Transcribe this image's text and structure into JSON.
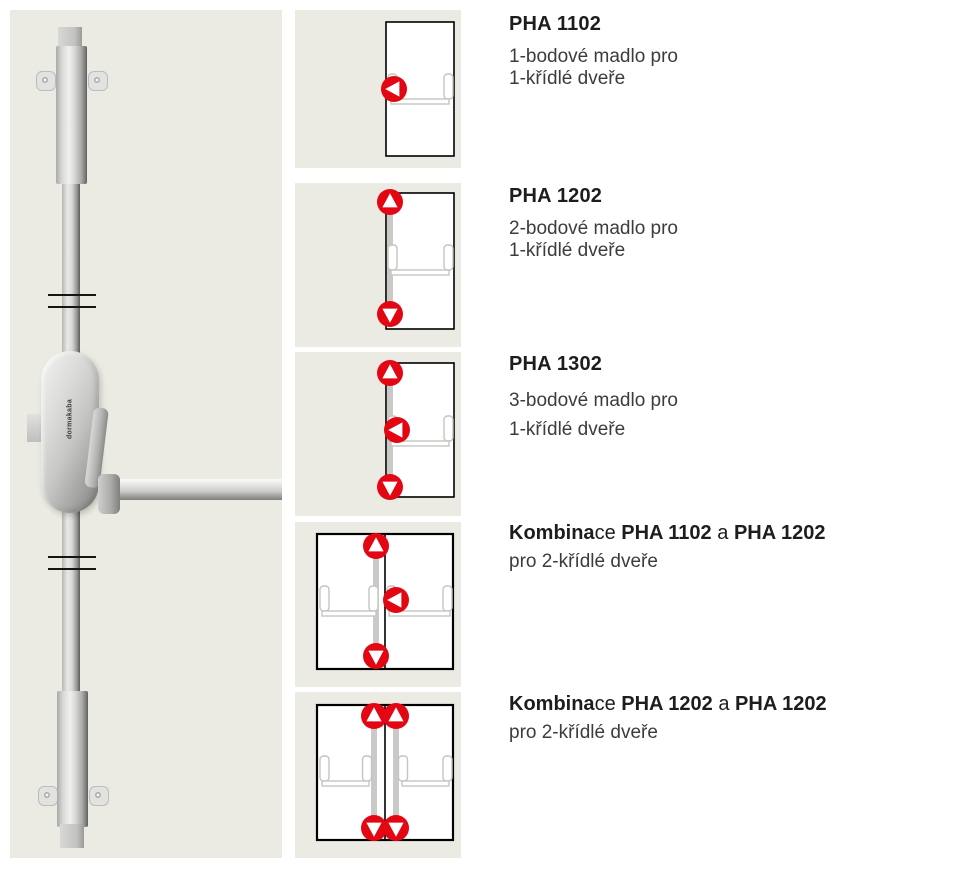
{
  "colors": {
    "accent_red": "#e30613",
    "panel_bg": "#ebebe3",
    "hardware_gray": "#c9c9c7",
    "door_outline": "#000000"
  },
  "device": {
    "logo_text": "dormakaba"
  },
  "products": [
    {
      "code": "PHA 1102",
      "description": [
        "1-bodové madlo pro",
        "1-křídlé dveře"
      ],
      "diagram": {
        "doors": 1,
        "points": [
          {
            "dir": "left",
            "x": 99,
            "y": 79
          }
        ]
      }
    },
    {
      "code": "PHA 1202",
      "description": [
        "2-bodové madlo pro",
        "1-křídlé dveře"
      ],
      "diagram": {
        "doors": 1,
        "points": [
          {
            "dir": "up",
            "x": 95,
            "y": 19
          },
          {
            "dir": "down",
            "x": 95,
            "y": 131
          }
        ]
      }
    },
    {
      "code": "PHA 1302",
      "description": [
        "3-bodové madlo pro",
        "1-křídlé dveře"
      ],
      "diagram": {
        "doors": 1,
        "points": [
          {
            "dir": "up",
            "x": 95,
            "y": 21
          },
          {
            "dir": "left",
            "x": 102,
            "y": 78
          },
          {
            "dir": "down",
            "x": 95,
            "y": 135
          }
        ]
      }
    },
    {
      "heading_parts": [
        "Kombina",
        "ce ",
        "PHA 1102",
        " a ",
        "PHA 1202"
      ],
      "description": [
        "pro 2-křídlé dveře"
      ],
      "diagram": {
        "doors": 2,
        "points": [
          {
            "dir": "up",
            "x": 81,
            "y": 24
          },
          {
            "dir": "left",
            "x": 101,
            "y": 78
          },
          {
            "dir": "down",
            "x": 81,
            "y": 134
          }
        ]
      }
    },
    {
      "heading_parts": [
        "Kombina",
        "ce ",
        "PHA 1202",
        " a ",
        "PHA 1202"
      ],
      "description": [
        "pro 2-křídlé dveře"
      ],
      "diagram": {
        "doors": 2,
        "points": [
          {
            "dir": "up",
            "x": 79,
            "y": 24
          },
          {
            "dir": "up",
            "x": 101,
            "y": 24
          },
          {
            "dir": "down",
            "x": 79,
            "y": 136
          },
          {
            "dir": "down",
            "x": 101,
            "y": 136
          }
        ]
      }
    }
  ]
}
